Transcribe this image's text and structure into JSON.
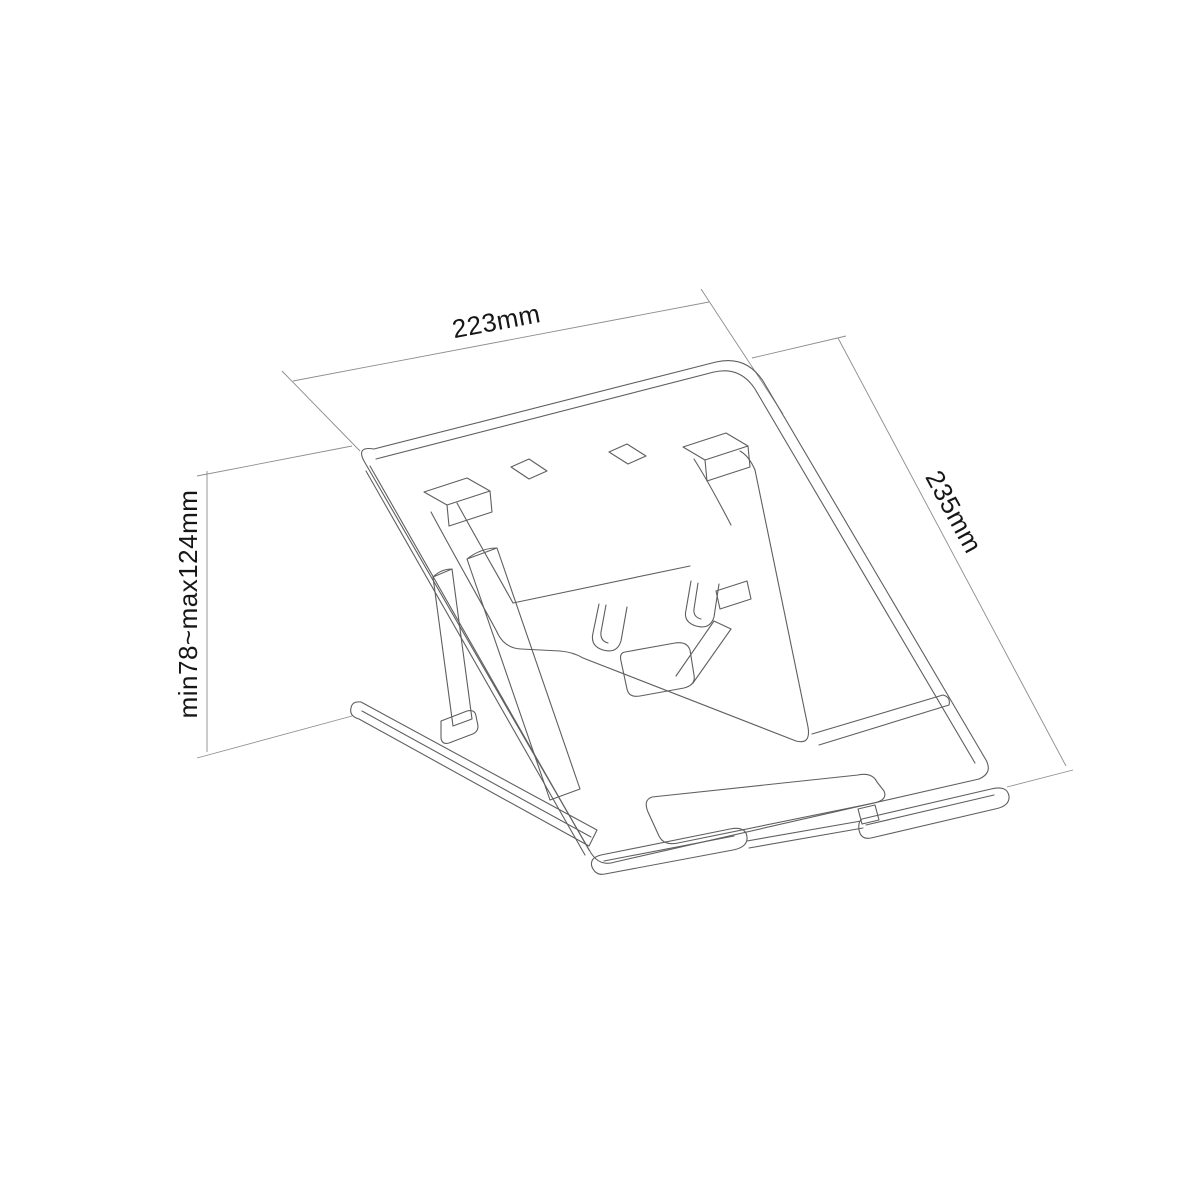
{
  "page": {
    "title": "Adjustable laptop stand - dimensional technical drawing"
  },
  "diagram": {
    "type": "technical-line-drawing",
    "subject": "foldable laptop stand, isometric view with dimension callouts",
    "colors": {
      "background": "#ffffff",
      "line": "#5f5f5f",
      "dimension_line": "#8d8d8d",
      "text": "#161616"
    },
    "dimensions": {
      "width": {
        "label": "223mm"
      },
      "depth": {
        "label": "235mm"
      },
      "height": {
        "label": "min78~max124mm"
      }
    }
  }
}
